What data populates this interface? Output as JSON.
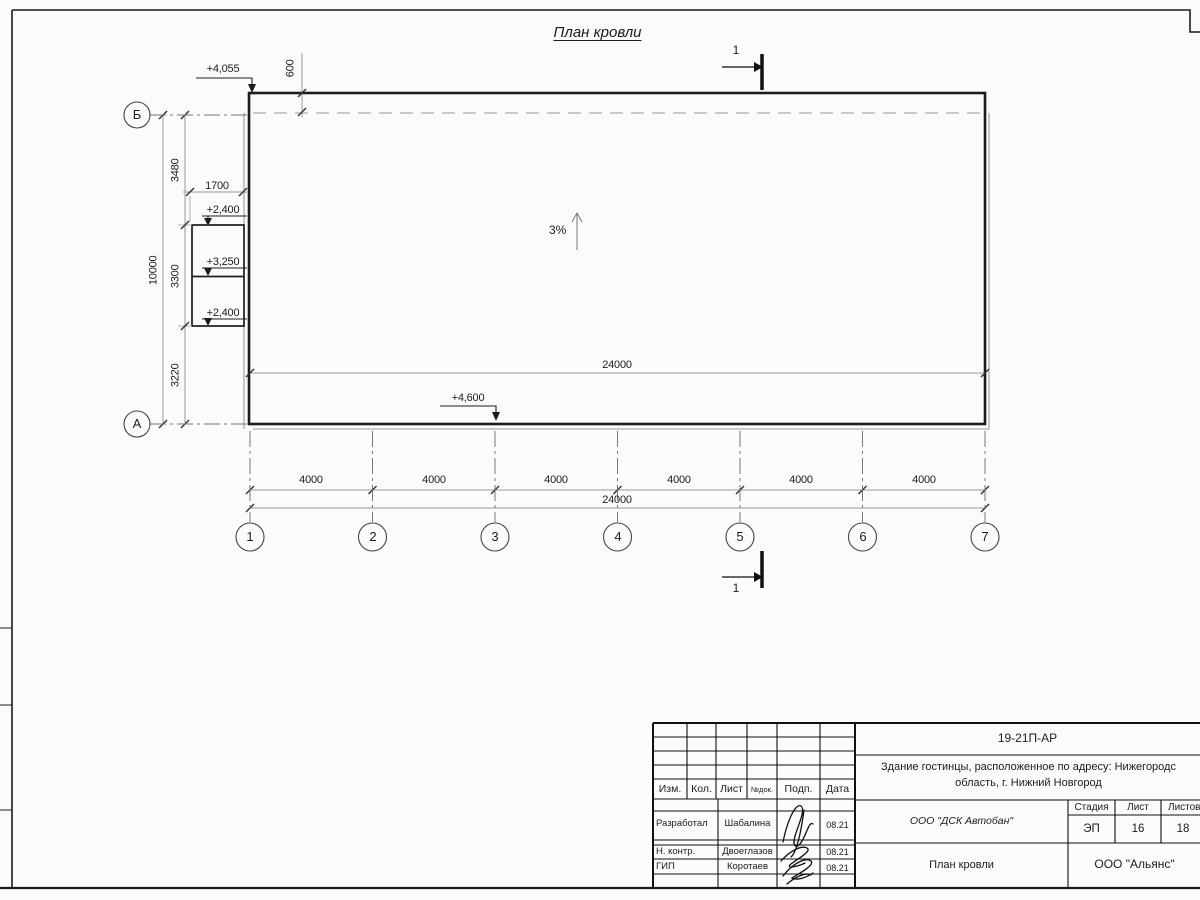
{
  "sheet": {
    "title": "План кровли"
  },
  "drawing": {
    "slope": "3%",
    "section_label": "1",
    "elevations": {
      "top": "+4,055",
      "canopy_top": "+2,400",
      "canopy_mid": "+3,250",
      "canopy_low": "+2,400",
      "bottom": "+4,600"
    },
    "dimensions": {
      "overhang": "600",
      "canopy": "1700",
      "total_vertical": "10000",
      "seg_top": "3480",
      "seg_mid": "3300",
      "seg_bottom": "3220",
      "spans": [
        "4000",
        "4000",
        "4000",
        "4000",
        "4000",
        "4000"
      ],
      "total_horizontal": "24000"
    },
    "axes_vertical": [
      "Б",
      "А"
    ],
    "axes_horizontal": [
      "1",
      "2",
      "3",
      "4",
      "5",
      "6",
      "7"
    ]
  },
  "titleblock": {
    "doc_number": "19-21П-АР",
    "project_line1": "Здание гостинцы, расположенное по адресу: Нижегородс",
    "project_line2": "область, г. Нижний Новгород",
    "columns": {
      "izm": "Изм.",
      "kol": "Кол.",
      "list": "Лист",
      "ndok": "№док.",
      "podp": "Подп.",
      "data": "Дата"
    },
    "stage": {
      "header_stage": "Стадия",
      "header_list": "Лист",
      "header_listov": "Листов",
      "stage": "ЭП",
      "list": "16",
      "listov": "18"
    },
    "people": [
      {
        "role": "Разработал",
        "name": "Шабалина",
        "date": "08.21"
      },
      {
        "role": "Н. контр.",
        "name": "Двоеглазов",
        "date": "08.21"
      },
      {
        "role": "ГИП",
        "name": "Коротаев",
        "date": "08.21"
      }
    ],
    "company": "ООО \"ДСК Автобан\"",
    "sheet_name": "План кровли",
    "org": "ООО \"Альянс\""
  }
}
